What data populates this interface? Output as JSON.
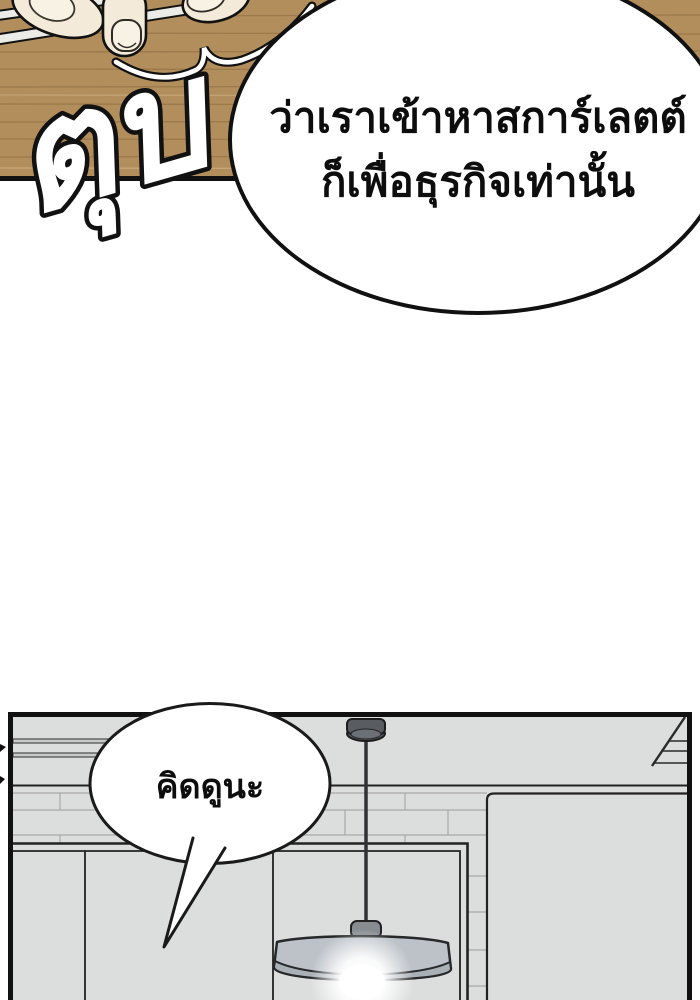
{
  "page": {
    "width": 700,
    "height": 1000,
    "background": "#ffffff"
  },
  "panel_top": {
    "sfx_text": "ตุบ",
    "speech_bubble": {
      "line1": "ว่าเราเข้าหาสการ์เลตต์",
      "line2": "ก็เพื่อธุรกิจเท่านั้น"
    },
    "colors": {
      "wood": "#b28e5c",
      "outline": "#111111",
      "skin": "#f3ead9",
      "nail": "#f8f2e5",
      "chopstick": "#ebebe8"
    }
  },
  "panel_bottom": {
    "speech_bubble": {
      "text": "คิดดูนะ"
    },
    "colors": {
      "wall": "#dcdddd",
      "mortar": "#a9a9a9",
      "outline": "#111111",
      "lamp_canopy": "#595d61",
      "lamp_underside": "#6b7076",
      "lamp_rod": "#303234",
      "lamp_socket": "#878c91",
      "lamp_shade": "#bcc2c8",
      "lamp_rim": "#a9b0b6",
      "bulb": "#ffffff"
    }
  }
}
